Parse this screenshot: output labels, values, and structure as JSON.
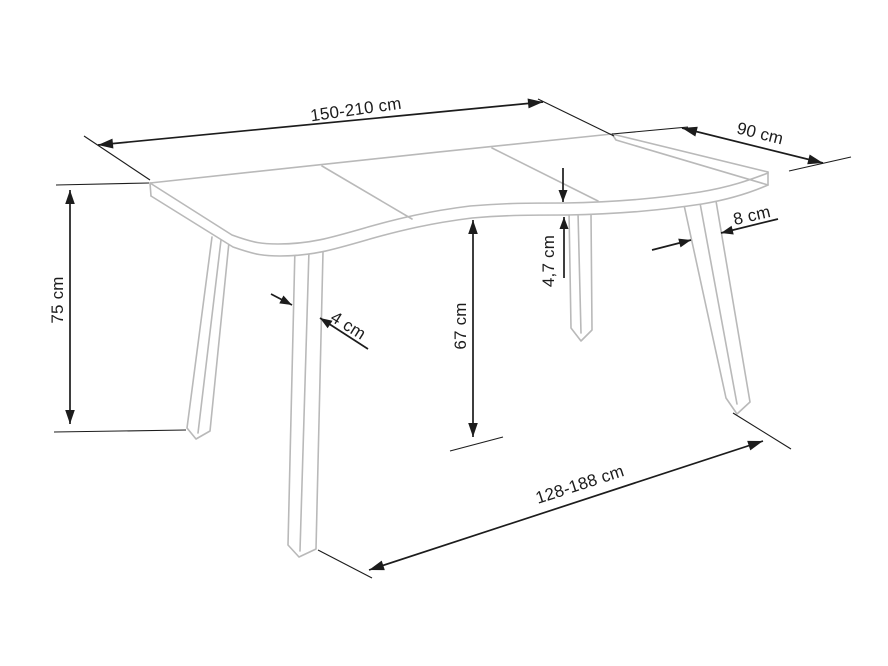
{
  "figure": {
    "title": "Table dimensions diagram",
    "subject": "Extendable dining table with wavy tabletop edge, perspective technical line drawing with dimension arrows",
    "background_color": "#ffffff",
    "drawing_line_color": "#b9b9b9",
    "dimension_line_color": "#1c1c1c",
    "unit": "cm"
  },
  "dimensions": {
    "top_length": {
      "label": "150-210 cm"
    },
    "top_depth": {
      "label": "90 cm"
    },
    "right_leg_thickness": {
      "label": "8 cm"
    },
    "top_thickness": {
      "label": "4,7 cm"
    },
    "underside_clearance": {
      "label": "67 cm"
    },
    "overall_height": {
      "label": "75 cm"
    },
    "left_leg_thickness": {
      "label": "4 cm"
    },
    "base_span": {
      "label": "128-188 cm"
    }
  }
}
